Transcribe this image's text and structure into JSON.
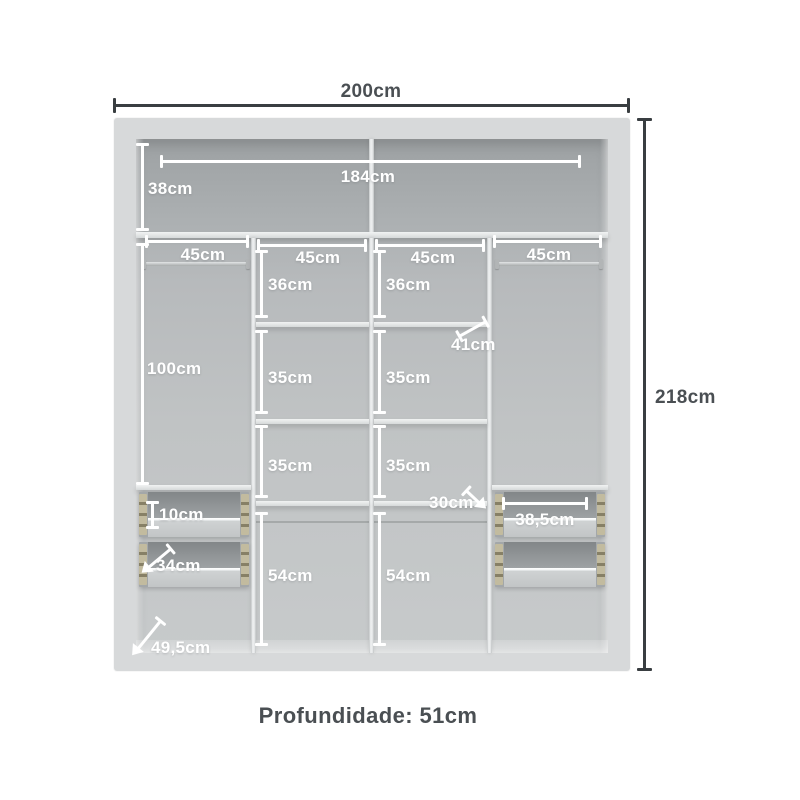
{
  "colors": {
    "frame": "#d7d9da",
    "dim_dark": "#393e41",
    "dim_light": "#ffffff",
    "text_dark": "#4a4f53",
    "rail": "#c2bb9f"
  },
  "outer": {
    "width_label": "200cm",
    "height_label": "218cm"
  },
  "top_section": {
    "height_label": "38cm",
    "inner_width_label": "184cm"
  },
  "columns": {
    "col1_width": "45cm",
    "col2_width": "45cm",
    "col3_width": "45cm",
    "col4_width": "45cm",
    "hang_height": "100cm"
  },
  "middle_sections": {
    "c2": [
      "36cm",
      "35cm",
      "35cm",
      "54cm"
    ],
    "c3": [
      "36cm",
      "35cm",
      "35cm",
      "54cm"
    ]
  },
  "callouts": {
    "shelf_depth": "41cm",
    "drawer_front_height": "10cm",
    "left_drawer_depth": "34cm",
    "right_drawer_width": "38,5cm",
    "right_drawer_depth": "30cm",
    "base_depth": "49,5cm"
  },
  "caption": {
    "depth": "Profundidade: 51cm"
  }
}
